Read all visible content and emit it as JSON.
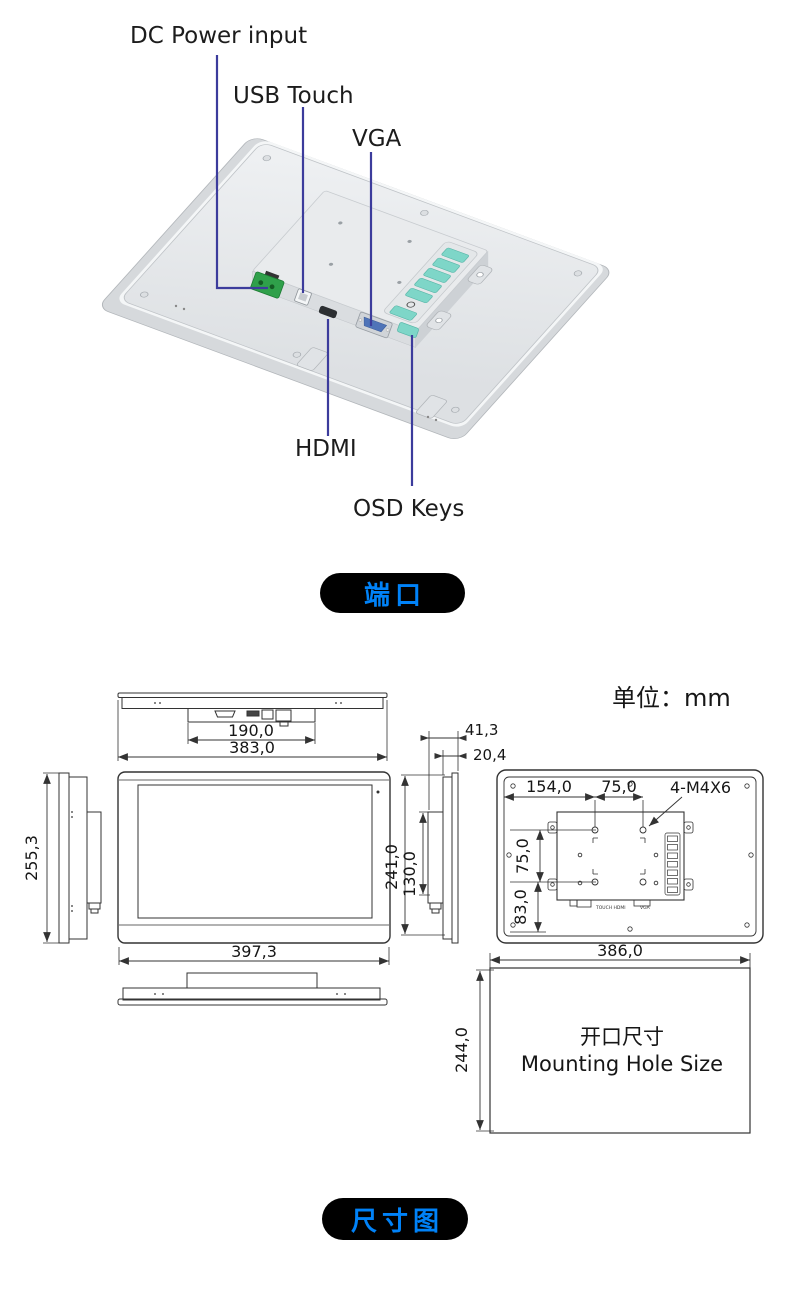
{
  "illustration": {
    "labels": {
      "dc_power": "DC Power input",
      "usb_touch": "USB Touch",
      "vga": "VGA",
      "hdmi": "HDMI",
      "osd_keys": "OSD Keys"
    }
  },
  "badges": {
    "ports": "端口",
    "dimensions": "尺寸图"
  },
  "drawing": {
    "unit_note": "单位：mm",
    "top_view": {
      "connector_width": "190,0",
      "body_width": "383,0"
    },
    "left_view": {
      "height": "255,3"
    },
    "front_view": {
      "width": "397,3"
    },
    "right_view": {
      "depth": "41,3",
      "front_depth": "20,4",
      "rear_height": "241,0",
      "box_height": "130,0"
    },
    "rear_view": {
      "hole_offset": "154,0",
      "hole_pitch_h": "75,0",
      "hole_pitch_v": "75,0",
      "bottom_offset": "83,0",
      "screw_spec": "4-M4X6",
      "connectors_label": "TOUCH HDMI",
      "vga_label": "VGA"
    },
    "cutout": {
      "width": "386,0",
      "height": "244,0",
      "title_cn": "开口尺寸",
      "title_en": "Mounting Hole Size"
    }
  },
  "colors": {
    "badge_text_blue": "#0082f8",
    "leader_line": "#3c3c9c",
    "osd_button_teal": "#7ed6c8",
    "dc_terminal_green": "#2fa04a",
    "vga_insert_blue": "#4f74b8"
  }
}
